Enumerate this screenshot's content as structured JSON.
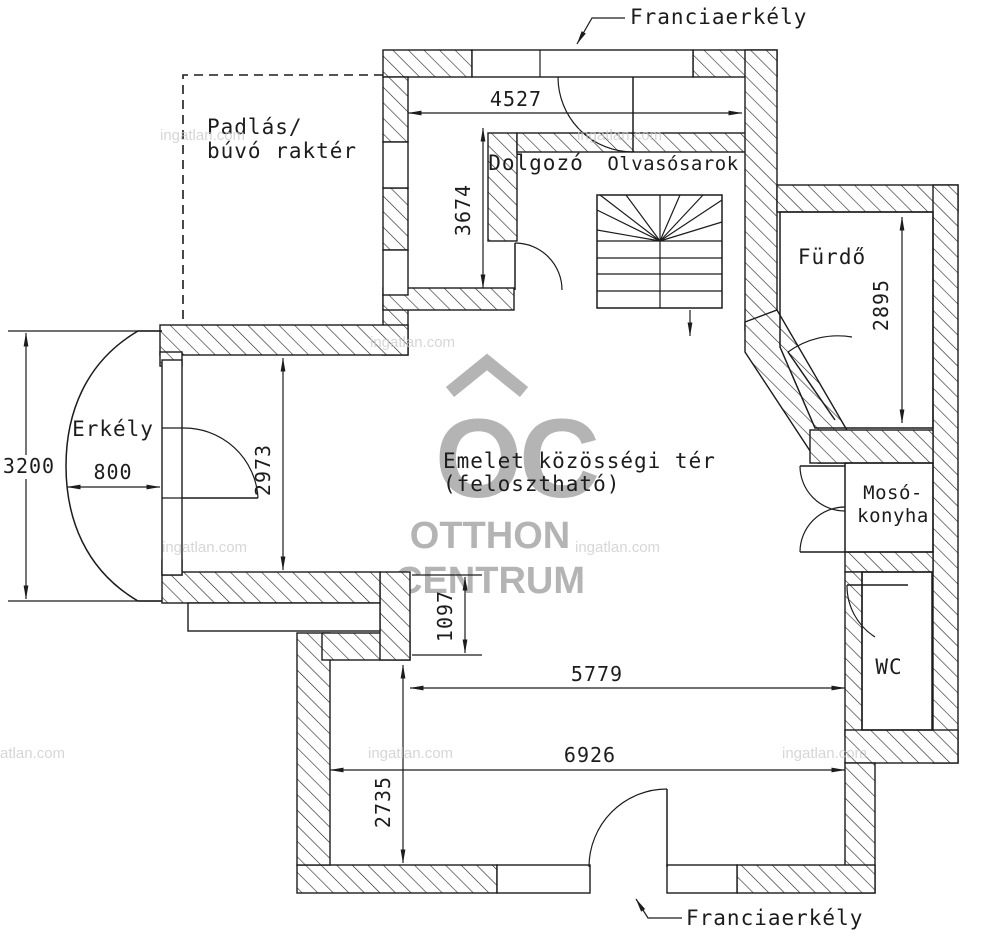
{
  "plan": {
    "title": "Emelet alaprajz",
    "rooms": {
      "attic_line1": "Padlás/",
      "attic_line2": "búvó raktér",
      "study": "Dolgozó",
      "reading": "Olvasósarok",
      "bath": "Fürdő",
      "balcony": "Erkély",
      "common_line1": "Emelet közösségi tér",
      "common_line2": "(felosztható)",
      "laundry_line1": "Mosó-",
      "laundry_line2": "konyha",
      "wc": "WC"
    },
    "callouts": {
      "french_balcony_top": "Franciaerkély",
      "french_balcony_bottom": "Franciaerkély"
    },
    "dimensions": {
      "d4527": "4527",
      "d3674": "3674",
      "d2895": "2895",
      "d3200": "3200",
      "d800": "800",
      "d2973": "2973",
      "d1097": "1097",
      "d5779": "5779",
      "d6926": "6926",
      "d2735": "2735"
    },
    "watermark": {
      "logo": "OC",
      "brand_line1": "OTTHON",
      "brand_line2": "CENTRUM",
      "site": "ingatlan.com",
      "brand_color": "#b4b4b4",
      "site_color": "#c9c9c9"
    },
    "colors": {
      "line": "#1c1c1c",
      "background": "#ffffff"
    }
  }
}
